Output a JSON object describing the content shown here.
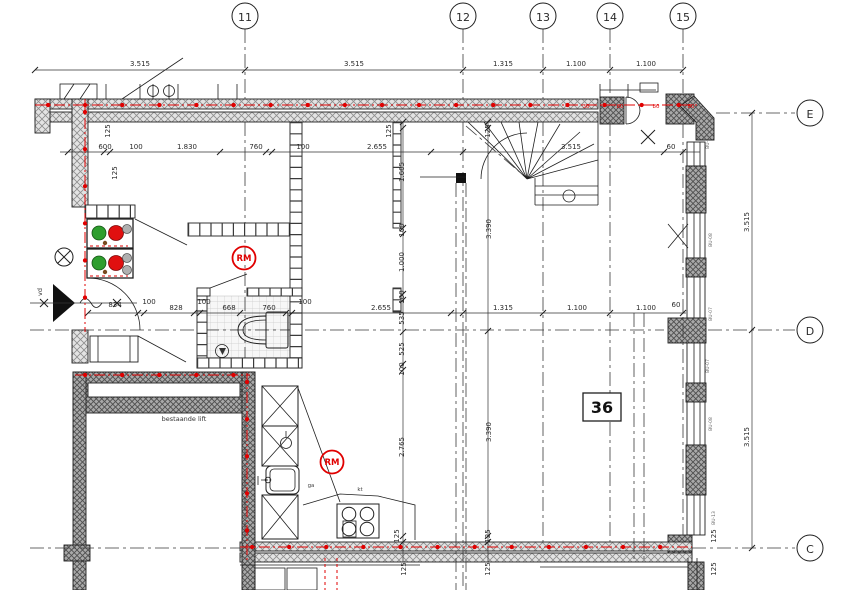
{
  "drawing": {
    "grid": {
      "cols": [
        "11",
        "12",
        "13",
        "14",
        "15"
      ],
      "rows": [
        "E",
        "D",
        "C"
      ]
    },
    "labels": {
      "room": "36",
      "rm": "RM",
      "lift": "bestaande lift",
      "vd": "vd",
      "ga": "ga",
      "kt": "kt",
      "f30": "30",
      "f80": "80",
      "bu13": "BU-13",
      "bu08": "BU-08",
      "bu07": "BU-07"
    },
    "colors": {
      "accent_red": "#e00000",
      "indicator_green": "#2e9e2e",
      "indicator_red": "#e01010",
      "wall_hatch": "#a9a9a9"
    }
  },
  "dims": {
    "top": [
      "3.515",
      "3.515",
      "1.315",
      "1.100",
      "1.100"
    ],
    "right": [
      "3.515",
      "3.515"
    ],
    "rowE": [
      "600",
      "100",
      "1.830",
      "760",
      "100",
      "2.655"
    ],
    "stair_width": "3.515",
    "d60": "60",
    "d125": "125",
    "rowD": [
      "834",
      "100",
      "828",
      "100",
      "668",
      "760",
      "100",
      "2.655",
      "1.315",
      "1.100",
      "1.100",
      "60"
    ],
    "vchain": [
      "125",
      "1.665",
      "100",
      "1.000",
      "100",
      "535",
      "525",
      "100"
    ],
    "v3390": "3.390",
    "v2765": "2.765"
  }
}
